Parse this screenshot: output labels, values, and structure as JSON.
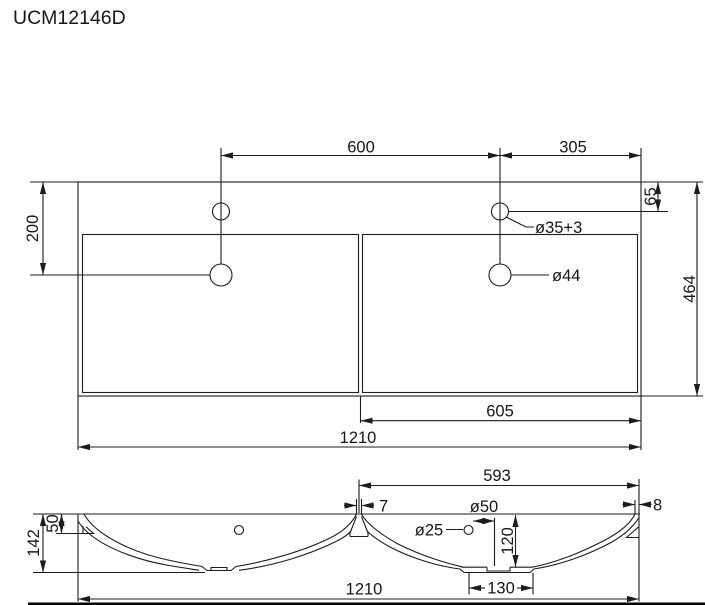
{
  "title": "UCM12146D",
  "colors": {
    "line": "#1c1c1c",
    "background": "#ffffff"
  },
  "top_view": {
    "faucet_spacing": "600",
    "faucet_to_right_edge": "305",
    "drain_from_back": "200",
    "faucet_from_back": "65",
    "overall_depth": "464",
    "faucet_hole_label": "ø35+3",
    "drain_hole_label": "ø44",
    "right_basin_width": "605",
    "overall_width": "1210"
  },
  "section_view": {
    "rim_to_divider": "593",
    "divider_top_width": "7",
    "rim_edge_width": "8",
    "drain_hole_label": "ø50",
    "overflow_hole_label": "ø25",
    "drain_depth": "120",
    "recess_width": "130",
    "ledge_depth": "50",
    "overall_height": "142",
    "overall_width": "1210"
  }
}
